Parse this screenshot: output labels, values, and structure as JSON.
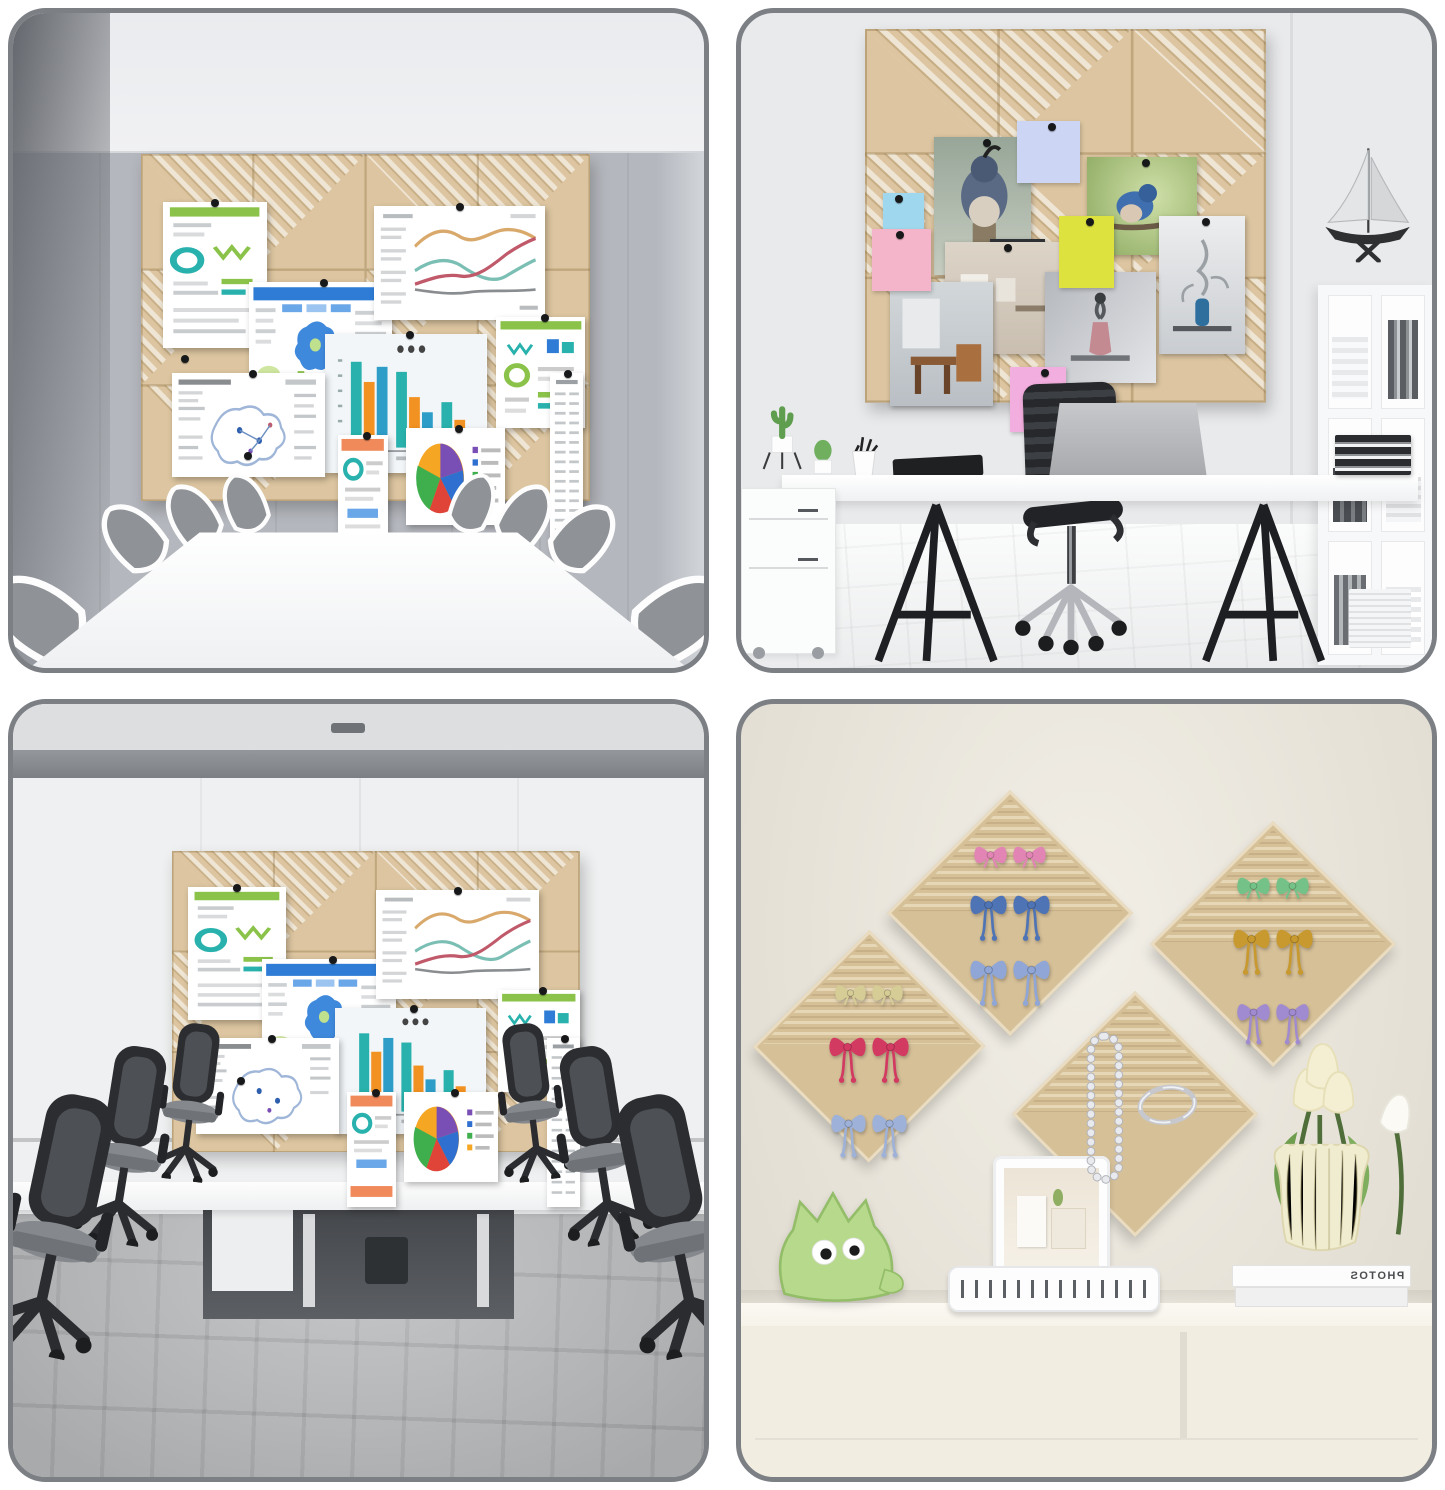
{
  "collage": {
    "kind": "product photo collage, 2x2 grid of room scenes with felt pin boards",
    "book_spine_text": "PHOTOS",
    "quadrants": [
      {
        "id": "conference-room",
        "scene": "beige felt tile pin board (4x3 tiles, diagonal stripe texture) with pinned charts above a white conference table ringed by gray chairs"
      },
      {
        "id": "home-office",
        "scene": "beige felt tile pin board (3x3 tiles) with bird photos and sticky notes above a white trestle desk with laptop, black chair, bookshelf and model sailboat"
      },
      {
        "id": "meeting-room",
        "scene": "beige felt tile pin board with pinned charts on a white wall, black mesh office chairs and gray plank floor"
      },
      {
        "id": "craft-wall",
        "scene": "four diamond-hung felt boards holding pairs of ribbon bows, a pearl necklace and a bangle, above a cream sideboard with plush toy, clip tray, tablet, books and a vase of tulips"
      }
    ],
    "pinned_items": {
      "charts": [
        "green infographic",
        "blue map dashboard",
        "multi-line chart",
        "grouped bar chart",
        "green infographic small",
        "map document",
        "orange mobile report",
        "pie chart with legend",
        "long list strip"
      ],
      "stickies": [
        "blue",
        "pink",
        "yellow",
        "lavender",
        "light-pink"
      ],
      "photos": [
        "quail bird",
        "blue bird",
        "interior room",
        "cafe corner",
        "vase still-life",
        "vase sketch",
        "dark doorway"
      ],
      "bow_pairs": {
        "top_center_diamond": [
          "pink",
          "blue",
          "light-blue"
        ],
        "left_diamond": [
          "cream",
          "red",
          "blue-stripe"
        ],
        "right_diamond": [
          "green",
          "gold",
          "purple"
        ],
        "bottom_center_diamond": [
          "pearl necklace",
          "silver bangle"
        ]
      }
    }
  },
  "colors": {
    "page_bg": "#ffffff",
    "frame_border": "#7c7f84",
    "board_tan": "#dcc5a0",
    "board_line": "#b2975f",
    "wall_q1": "#b4b7bd",
    "ceiling_q1": "#f0f1f3",
    "wall_corner_q1": "#63666c",
    "table_white": "#fdfdfd",
    "chair_fabric": "#8f9296",
    "wall_q2": "#e9eaec",
    "floor_q2": "#f4f5f5",
    "desk_white": "#fafbfb",
    "ink_black": "#222428",
    "laptop_gray": "#b9bbbe",
    "shelf_white": "#f7f8f9",
    "wall_q3": "#eff0f1",
    "beam_q3": "#85888c",
    "floor_q3": "#aeb0b2",
    "opening_q3": "#505356",
    "wall_q4": "#ebe6da",
    "counter_q4": "#f6f3ea",
    "cabinet_q4": "#f1ede1",
    "diamond_tan": "#d6c098",
    "diamond_stripe": "#e6d7b6",
    "plush_green": "#b7d98b",
    "vase_cream": "#efeccf",
    "tulip_cream": "#f4efd2",
    "leaf_green": "#6f9e4e",
    "sticky_blue": "#9fd8ee",
    "sticky_pink": "#f4b5cb",
    "sticky_yellow": "#dde23f",
    "sticky_lavender": "#cdd5f5",
    "sticky_pinklight": "#f2aede",
    "bow_pink": "#e285b5",
    "bow_blue": "#4f74b5",
    "bow_lightblue": "#8fa6d6",
    "bow_cream": "#d6cc96",
    "bow_red": "#d23a62",
    "bow_green": "#74c287",
    "bow_gold": "#c8992e",
    "bow_purple": "#a08ad0",
    "bow_bluestripe": "#9db1d9",
    "chart_teal": "#29b2ad",
    "chart_orange": "#f29222",
    "chart_green": "#8bc34a",
    "chart_blue": "#2e7cd6",
    "pie_purple": "#7a4fb5",
    "pie_blue": "#2f6fd0",
    "pie_green": "#3faf4e",
    "pie_orange": "#f5a623",
    "pie_red": "#e04438",
    "doc_orange": "#f08a5a",
    "pearl": "#e9eaee",
    "silver": "#c6c8cd"
  }
}
